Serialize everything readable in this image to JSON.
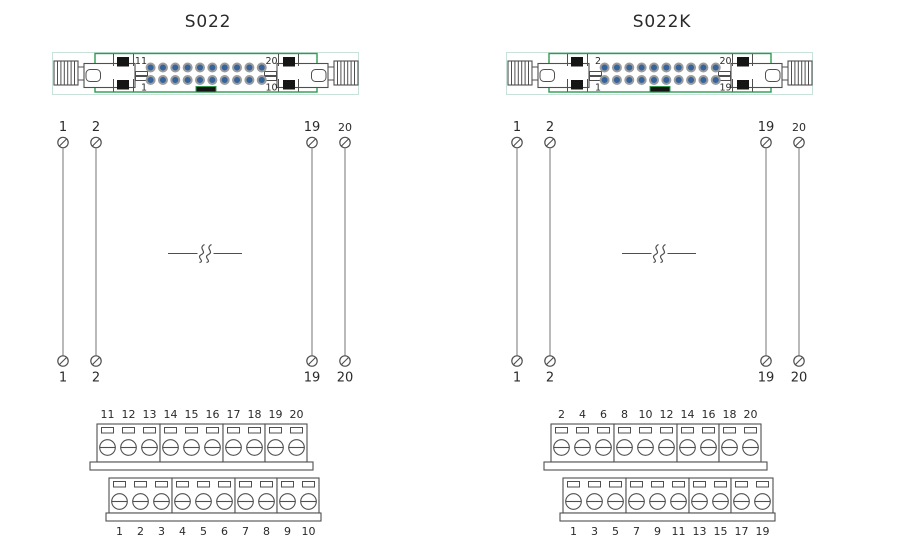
{
  "page": {
    "background": "#ffffff"
  },
  "colors": {
    "stroke_dark": "#4f4f4f",
    "wire_gray": "#8b8b8b",
    "text": "#2a2a2a",
    "connector_green": "#2f9b51",
    "faint_outline": "#c9e2d9",
    "pin_blue": "#35639c",
    "pin_ring": "#9c9c9c",
    "key_black": "#151515"
  },
  "icons": {
    "wire_end": "circle-slash-terminal-icon",
    "cable_break": "double-squiggle-break-icon",
    "terminal_screw": "screw-head-icon"
  },
  "diagrams": [
    {
      "title": "S022",
      "connector": {
        "pin_rows": 2,
        "pin_cols": 10,
        "corner_labels": {
          "top_left": "11",
          "bottom_left": "1",
          "top_right": "20",
          "bottom_right": "10"
        }
      },
      "wires": [
        {
          "top_label": "1",
          "bottom_label": "1"
        },
        {
          "top_label": "2",
          "bottom_label": "2"
        },
        {
          "top_label": "19",
          "bottom_label": "19"
        },
        {
          "top_label": "20",
          "bottom_label": "20"
        }
      ],
      "cable_break": true,
      "terminal_block": {
        "top_row": {
          "groups": [
            [
              "11",
              "12",
              "13"
            ],
            [
              "14",
              "15",
              "16"
            ],
            [
              "17",
              "18"
            ],
            [
              "19",
              "20"
            ]
          ]
        },
        "bottom_row": {
          "groups": [
            [
              "1",
              "2",
              "3"
            ],
            [
              "4",
              "5",
              "6"
            ],
            [
              "7",
              "8"
            ],
            [
              "9",
              "10"
            ]
          ]
        }
      }
    },
    {
      "title": "S022K",
      "connector": {
        "pin_rows": 2,
        "pin_cols": 10,
        "corner_labels": {
          "top_left": "2",
          "bottom_left": "1",
          "top_right": "20",
          "bottom_right": "19"
        }
      },
      "wires": [
        {
          "top_label": "1",
          "bottom_label": "1"
        },
        {
          "top_label": "2",
          "bottom_label": "2"
        },
        {
          "top_label": "19",
          "bottom_label": "19"
        },
        {
          "top_label": "20",
          "bottom_label": "20"
        }
      ],
      "cable_break": true,
      "terminal_block": {
        "top_row": {
          "groups": [
            [
              "2",
              "4",
              "6"
            ],
            [
              "8",
              "10",
              "12"
            ],
            [
              "14",
              "16"
            ],
            [
              "18",
              "20"
            ]
          ]
        },
        "bottom_row": {
          "groups": [
            [
              "1",
              "3",
              "5"
            ],
            [
              "7",
              "9",
              "11"
            ],
            [
              "13",
              "15"
            ],
            [
              "17",
              "19"
            ]
          ]
        }
      }
    }
  ]
}
